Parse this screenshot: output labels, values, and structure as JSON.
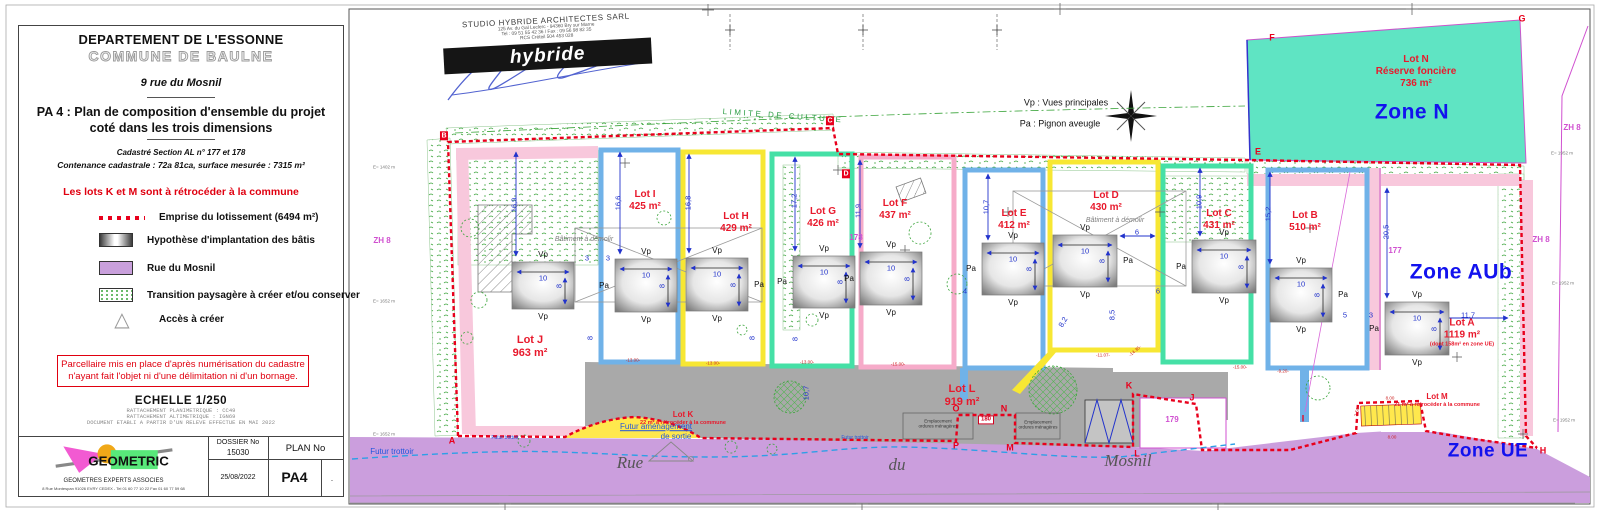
{
  "colors": {
    "emprise_red": "#e8001c",
    "lot_blue": "#70b2e8",
    "lot_yellow": "#f7e733",
    "lot_teal": "#45e0a6",
    "lot_pink": "#f6abc9",
    "zone_n_cyan": "#5fe4c3",
    "road_purple": "#cb9edd",
    "drive_gray": "#a9a9a9",
    "zone_text_blue": "#1212ee",
    "lot_text_red": "#e8192c",
    "magenta": "#d050d0"
  },
  "left_panel": {
    "department": "DEPARTEMENT DE L'ESSONNE",
    "commune": "COMMUNE DE BAULNE",
    "address": "9 rue du Mosnil",
    "title_line1": "PA 4 : Plan de composition d'ensemble du projet",
    "title_line2": "coté dans les trois dimensions",
    "cadastre": "Cadastré Section AL n° 177 et 178",
    "contenance": "Contenance cadastrale : 72a 81ca, surface mesurée : 7315 m²",
    "red_note": "Les lots K et M sont à rétrocéder à la commune",
    "legend": [
      {
        "label": "Emprise du lotissement (6494 m²)"
      },
      {
        "label": "Hypothèse d'implantation des bâtis"
      },
      {
        "label": "Rue du Mosnil"
      },
      {
        "label": "Transition paysagère à créer et/ou conserver"
      },
      {
        "label": "Accès à créer"
      }
    ],
    "triangle_glyph": "△",
    "disclaimer": "Parcellaire mis en place d'après numérisation du cadastre\nn'ayant fait l'objet ni d'une délimitation ni d'un bornage.",
    "scale": "ECHELLE 1/250",
    "ref1": "RATTACHEMENT PLANIMETRIQUE : CC49",
    "ref2": "RATTACHEMENT ALTIMETRIQUE : IGN69",
    "ref3": "DOCUMENT ETABLI A PARTIR D'UN RELEVE EFFECTUE EN MAI 2022",
    "firm": {
      "logo_text": "GEOMETRIC",
      "subtitle": "GEOMETRES EXPERTS ASSOCIES",
      "address": "8 Rue Montespan 91026 EVRY CEDEX - Tel 01 60 77 10 22 Fax 01 60 77 59 68"
    },
    "titleblock": {
      "dossier_label": "DOSSIER No",
      "dossier_no": "15030",
      "plan_label": "PLAN No",
      "date": "25/08/2022",
      "plan_no": "PA4",
      "rev": "."
    }
  },
  "stamp": {
    "line1": "STUDIO HYBRIDE ARCHITECTES SARL",
    "line2": "125 Av. du Gal Leclerc - 94360 Bry sur Marne",
    "line3": "Tel : 09 51 55 42 36 / Fax : 09 56 98 82 35",
    "line4": "RCS Créteil 504 453 028",
    "banner": "hybride"
  },
  "plan": {
    "building_labels": {
      "vp": "Vp",
      "pa": "Pa",
      "width": "10",
      "depth": "8"
    },
    "zones": [
      {
        "label": "Zone N",
        "x": 1412,
        "y": 112,
        "size": 21
      },
      {
        "label": "Zone AUb",
        "x": 1461,
        "y": 272,
        "size": 21
      },
      {
        "label": "Zone UE",
        "x": 1488,
        "y": 452,
        "size": 19
      }
    ],
    "lots": [
      {
        "name": "Lot J",
        "area": "963 m²",
        "x": 530,
        "y": 347,
        "size": 11
      },
      {
        "name": "Lot I",
        "area": "425 m²",
        "x": 645,
        "y": 201,
        "size": 10
      },
      {
        "name": "Lot H",
        "area": "429 m²",
        "x": 736,
        "y": 223,
        "size": 10
      },
      {
        "name": "Lot G",
        "area": "426 m²",
        "x": 823,
        "y": 218,
        "size": 10
      },
      {
        "name": "Lot F",
        "area": "437 m²",
        "x": 895,
        "y": 210,
        "size": 10
      },
      {
        "name": "Lot E",
        "area": "412 m²",
        "x": 1014,
        "y": 220,
        "size": 10
      },
      {
        "name": "Lot D",
        "area": "430 m²",
        "x": 1106,
        "y": 202,
        "size": 10
      },
      {
        "name": "Lot C",
        "area": "431 m²",
        "x": 1219,
        "y": 220,
        "size": 10
      },
      {
        "name": "Lot B",
        "area": "510 m²",
        "x": 1305,
        "y": 222,
        "size": 10
      },
      {
        "name": "Lot A",
        "area": "1119 m²",
        "note": "(dont 158m² en zone UE)",
        "x": 1462,
        "y": 333,
        "size": 10
      },
      {
        "name": "Lot L",
        "area": "919 m²",
        "x": 962,
        "y": 396,
        "size": 11
      },
      {
        "name": "Lot K",
        "note": "22 m² à rétrocéder à la commune",
        "x": 683,
        "y": 418,
        "size": 8
      },
      {
        "name": "Lot M",
        "note": "21 m² à rétrocéder à la commune",
        "x": 1437,
        "y": 400,
        "size": 8
      },
      {
        "name": "Lot N",
        "line2": "Réserve foncière",
        "area": "736 m²",
        "x": 1416,
        "y": 72,
        "size": 10
      }
    ],
    "letters": [
      {
        "t": "A",
        "x": 452,
        "y": 441
      },
      {
        "t": "B",
        "x": 444,
        "y": 136,
        "box": 1
      },
      {
        "t": "C",
        "x": 830,
        "y": 121,
        "box": 1
      },
      {
        "t": "D",
        "x": 846,
        "y": 174,
        "box": 1
      },
      {
        "t": "E",
        "x": 1258,
        "y": 152
      },
      {
        "t": "F",
        "x": 1272,
        "y": 38
      },
      {
        "t": "G",
        "x": 1522,
        "y": 19
      },
      {
        "t": "H",
        "x": 1543,
        "y": 451
      },
      {
        "t": "I",
        "x": 1303,
        "y": 419
      },
      {
        "t": "J",
        "x": 1192,
        "y": 398
      },
      {
        "t": "K",
        "x": 1129,
        "y": 386
      },
      {
        "t": "L",
        "x": 1137,
        "y": 454
      },
      {
        "t": "M",
        "x": 1010,
        "y": 448
      },
      {
        "t": "N",
        "x": 1004,
        "y": 409
      },
      {
        "t": "O",
        "x": 956,
        "y": 409
      },
      {
        "t": "P",
        "x": 956,
        "y": 446
      }
    ],
    "buildings": [
      {
        "x": 512,
        "y": 262,
        "w": 62,
        "h": 47,
        "pa": null
      },
      {
        "x": 615,
        "y": 259,
        "w": 62,
        "h": 53,
        "pa": "left"
      },
      {
        "x": 686,
        "y": 258,
        "w": 62,
        "h": 53,
        "pa": "right"
      },
      {
        "x": 793,
        "y": 256,
        "w": 62,
        "h": 52,
        "pa": "left"
      },
      {
        "x": 860,
        "y": 252,
        "w": 62,
        "h": 53,
        "pa": "left"
      },
      {
        "x": 982,
        "y": 243,
        "w": 62,
        "h": 52,
        "pa": "left"
      },
      {
        "x": 1053,
        "y": 235,
        "w": 64,
        "h": 52,
        "pa": "right"
      },
      {
        "x": 1192,
        "y": 240,
        "w": 64,
        "h": 53,
        "pa": "left"
      },
      {
        "x": 1270,
        "y": 268,
        "w": 62,
        "h": 54,
        "pa": "right"
      },
      {
        "x": 1385,
        "y": 302,
        "w": 64,
        "h": 53,
        "pa": "left"
      }
    ],
    "dims": [
      {
        "t": "16,9",
        "x": 514,
        "y": 205,
        "r": -90
      },
      {
        "t": "16,6",
        "x": 618,
        "y": 203,
        "r": -90
      },
      {
        "t": "16,8",
        "x": 688,
        "y": 203,
        "r": -90
      },
      {
        "t": "17,2",
        "x": 794,
        "y": 201,
        "r": -90
      },
      {
        "t": "11,9",
        "x": 858,
        "y": 211,
        "r": -90
      },
      {
        "t": "10,7",
        "x": 986,
        "y": 207,
        "r": -90
      },
      {
        "t": "10,9",
        "x": 1199,
        "y": 202,
        "r": -90
      },
      {
        "t": "15,2",
        "x": 1268,
        "y": 214,
        "r": -90
      },
      {
        "t": "20,5",
        "x": 1386,
        "y": 232,
        "r": -90
      },
      {
        "t": "10,7",
        "x": 806,
        "y": 393,
        "r": -90
      },
      {
        "t": "8",
        "x": 590,
        "y": 338,
        "r": -90
      },
      {
        "t": "8",
        "x": 752,
        "y": 338,
        "r": -90
      },
      {
        "t": "8",
        "x": 795,
        "y": 339,
        "r": -90
      },
      {
        "t": "8,5",
        "x": 1112,
        "y": 315,
        "r": -90
      },
      {
        "t": "8,2",
        "x": 1063,
        "y": 322,
        "r": -60
      },
      {
        "t": "3",
        "x": 587,
        "y": 258
      },
      {
        "t": "3",
        "x": 608,
        "y": 258
      },
      {
        "t": "6",
        "x": 1137,
        "y": 232
      },
      {
        "t": "6",
        "x": 1158,
        "y": 291
      },
      {
        "t": "4",
        "x": 965,
        "y": 291
      },
      {
        "t": "5",
        "x": 1345,
        "y": 315
      },
      {
        "t": "3",
        "x": 1371,
        "y": 315
      },
      {
        "t": "11,7",
        "x": 1468,
        "y": 315
      },
      {
        "t": "-13.00-",
        "x": 633,
        "y": 360,
        "c": "reddim"
      },
      {
        "t": "-13.00-",
        "x": 713,
        "y": 363,
        "c": "reddim"
      },
      {
        "t": "-13.00-",
        "x": 807,
        "y": 362,
        "c": "reddim"
      },
      {
        "t": "-15.00-",
        "x": 898,
        "y": 364,
        "c": "reddim"
      },
      {
        "t": "-11.07-",
        "x": 1103,
        "y": 355,
        "c": "reddim"
      },
      {
        "t": "-14.35-",
        "x": 1135,
        "y": 351,
        "r": -40,
        "c": "reddim"
      },
      {
        "t": "-15.00-",
        "x": 1240,
        "y": 367,
        "c": "reddim"
      },
      {
        "t": "-9.20-",
        "x": 1283,
        "y": 371,
        "c": "reddim"
      },
      {
        "t": "8.00",
        "x": 1390,
        "y": 398,
        "c": "reddim"
      },
      {
        "t": "8.00",
        "x": 1392,
        "y": 437,
        "c": "reddim"
      },
      {
        "t": "2.59",
        "x": 1357,
        "y": 412,
        "r": -75,
        "c": "reddim"
      }
    ],
    "misc": [
      {
        "t": "LIMITE DE CULTURE",
        "x": 783,
        "y": 116,
        "c": "cult",
        "r": 4,
        "n": "limite-de-culture-label"
      },
      {
        "t": "Vp : Vues principales",
        "x": 1066,
        "y": 103,
        "c": "black9",
        "n": "vp-legend"
      },
      {
        "t": "Pa : Pignon aveugle",
        "x": 1060,
        "y": 124,
        "c": "black9",
        "n": "pa-legend"
      },
      {
        "t": "Bâtiment à démolir",
        "x": 584,
        "y": 240,
        "c": "demol",
        "n": "batiment-a-demolir-label"
      },
      {
        "t": "Bâtiment à démolir",
        "x": 1115,
        "y": 221,
        "c": "demol",
        "n": "batiment-a-demolir-label"
      },
      {
        "t": "177",
        "x": 1395,
        "y": 251,
        "c": "mag",
        "n": "parcel-177-label"
      },
      {
        "t": "178",
        "x": 856,
        "y": 238,
        "c": "mag",
        "n": "parcel-178-label"
      },
      {
        "t": "179",
        "x": 1172,
        "y": 420,
        "c": "mag",
        "n": "parcel-179-label"
      },
      {
        "t": "180",
        "x": 986,
        "y": 420,
        "c": "red180",
        "n": "parcel-180-label"
      },
      {
        "t": "ZH 8",
        "x": 382,
        "y": 241,
        "c": "mag",
        "n": "zh8-label"
      },
      {
        "t": "ZH 8",
        "x": 1541,
        "y": 240,
        "c": "mag",
        "n": "zh8-label"
      },
      {
        "t": "ZH 8",
        "x": 1572,
        "y": 128,
        "c": "mag",
        "n": "zh8-label"
      },
      {
        "t": "Rue",
        "x": 630,
        "y": 463,
        "c": "road",
        "n": "street-name"
      },
      {
        "t": "du",
        "x": 897,
        "y": 465,
        "c": "road",
        "n": "street-name"
      },
      {
        "t": "Mosnil",
        "x": 1128,
        "y": 461,
        "c": "road",
        "n": "street-name"
      },
      {
        "t": "Futur trottoir",
        "x": 392,
        "y": 452,
        "c": "blue8",
        "n": "futur-trottoir-label"
      },
      {
        "t": "Futur trottoir",
        "x": 505,
        "y": 438,
        "c": "blue5",
        "n": "futur-trottoir-label"
      },
      {
        "t": "Futur trottoir",
        "x": 855,
        "y": 438,
        "c": "blue5",
        "n": "futur-trottoir-label"
      },
      {
        "t": "Futur aménagement",
        "x": 656,
        "y": 427,
        "c": "blue8 und",
        "n": "futur-amenagement-label"
      },
      {
        "t": "de sortie",
        "x": 676,
        "y": 437,
        "c": "blue8",
        "n": "futur-amenagement-label"
      },
      {
        "t": "Emplacement\nordures ménagères",
        "x": 938,
        "y": 424,
        "c": "tiny45",
        "n": "emplacement-ordures-label"
      },
      {
        "t": "Emplacement\nordures ménagères",
        "x": 1038,
        "y": 425,
        "c": "tiny45",
        "n": "emplacement-ordures-label"
      },
      {
        "t": "E= 1402 m",
        "x": 384,
        "y": 167,
        "c": "coord",
        "n": "grid-coordinate"
      },
      {
        "t": "E= 1652 m",
        "x": 384,
        "y": 301,
        "c": "coord",
        "n": "grid-coordinate"
      },
      {
        "t": "E= 1652 m",
        "x": 384,
        "y": 434,
        "c": "coord",
        "n": "grid-coordinate"
      },
      {
        "t": "E= 1952 m",
        "x": 1562,
        "y": 153,
        "c": "coord",
        "n": "grid-coordinate"
      },
      {
        "t": "E= 1952 m",
        "x": 1563,
        "y": 283,
        "c": "coord",
        "n": "grid-coordinate"
      },
      {
        "t": "E= 1952 m",
        "x": 1564,
        "y": 420,
        "c": "coord",
        "n": "grid-coordinate"
      }
    ]
  }
}
